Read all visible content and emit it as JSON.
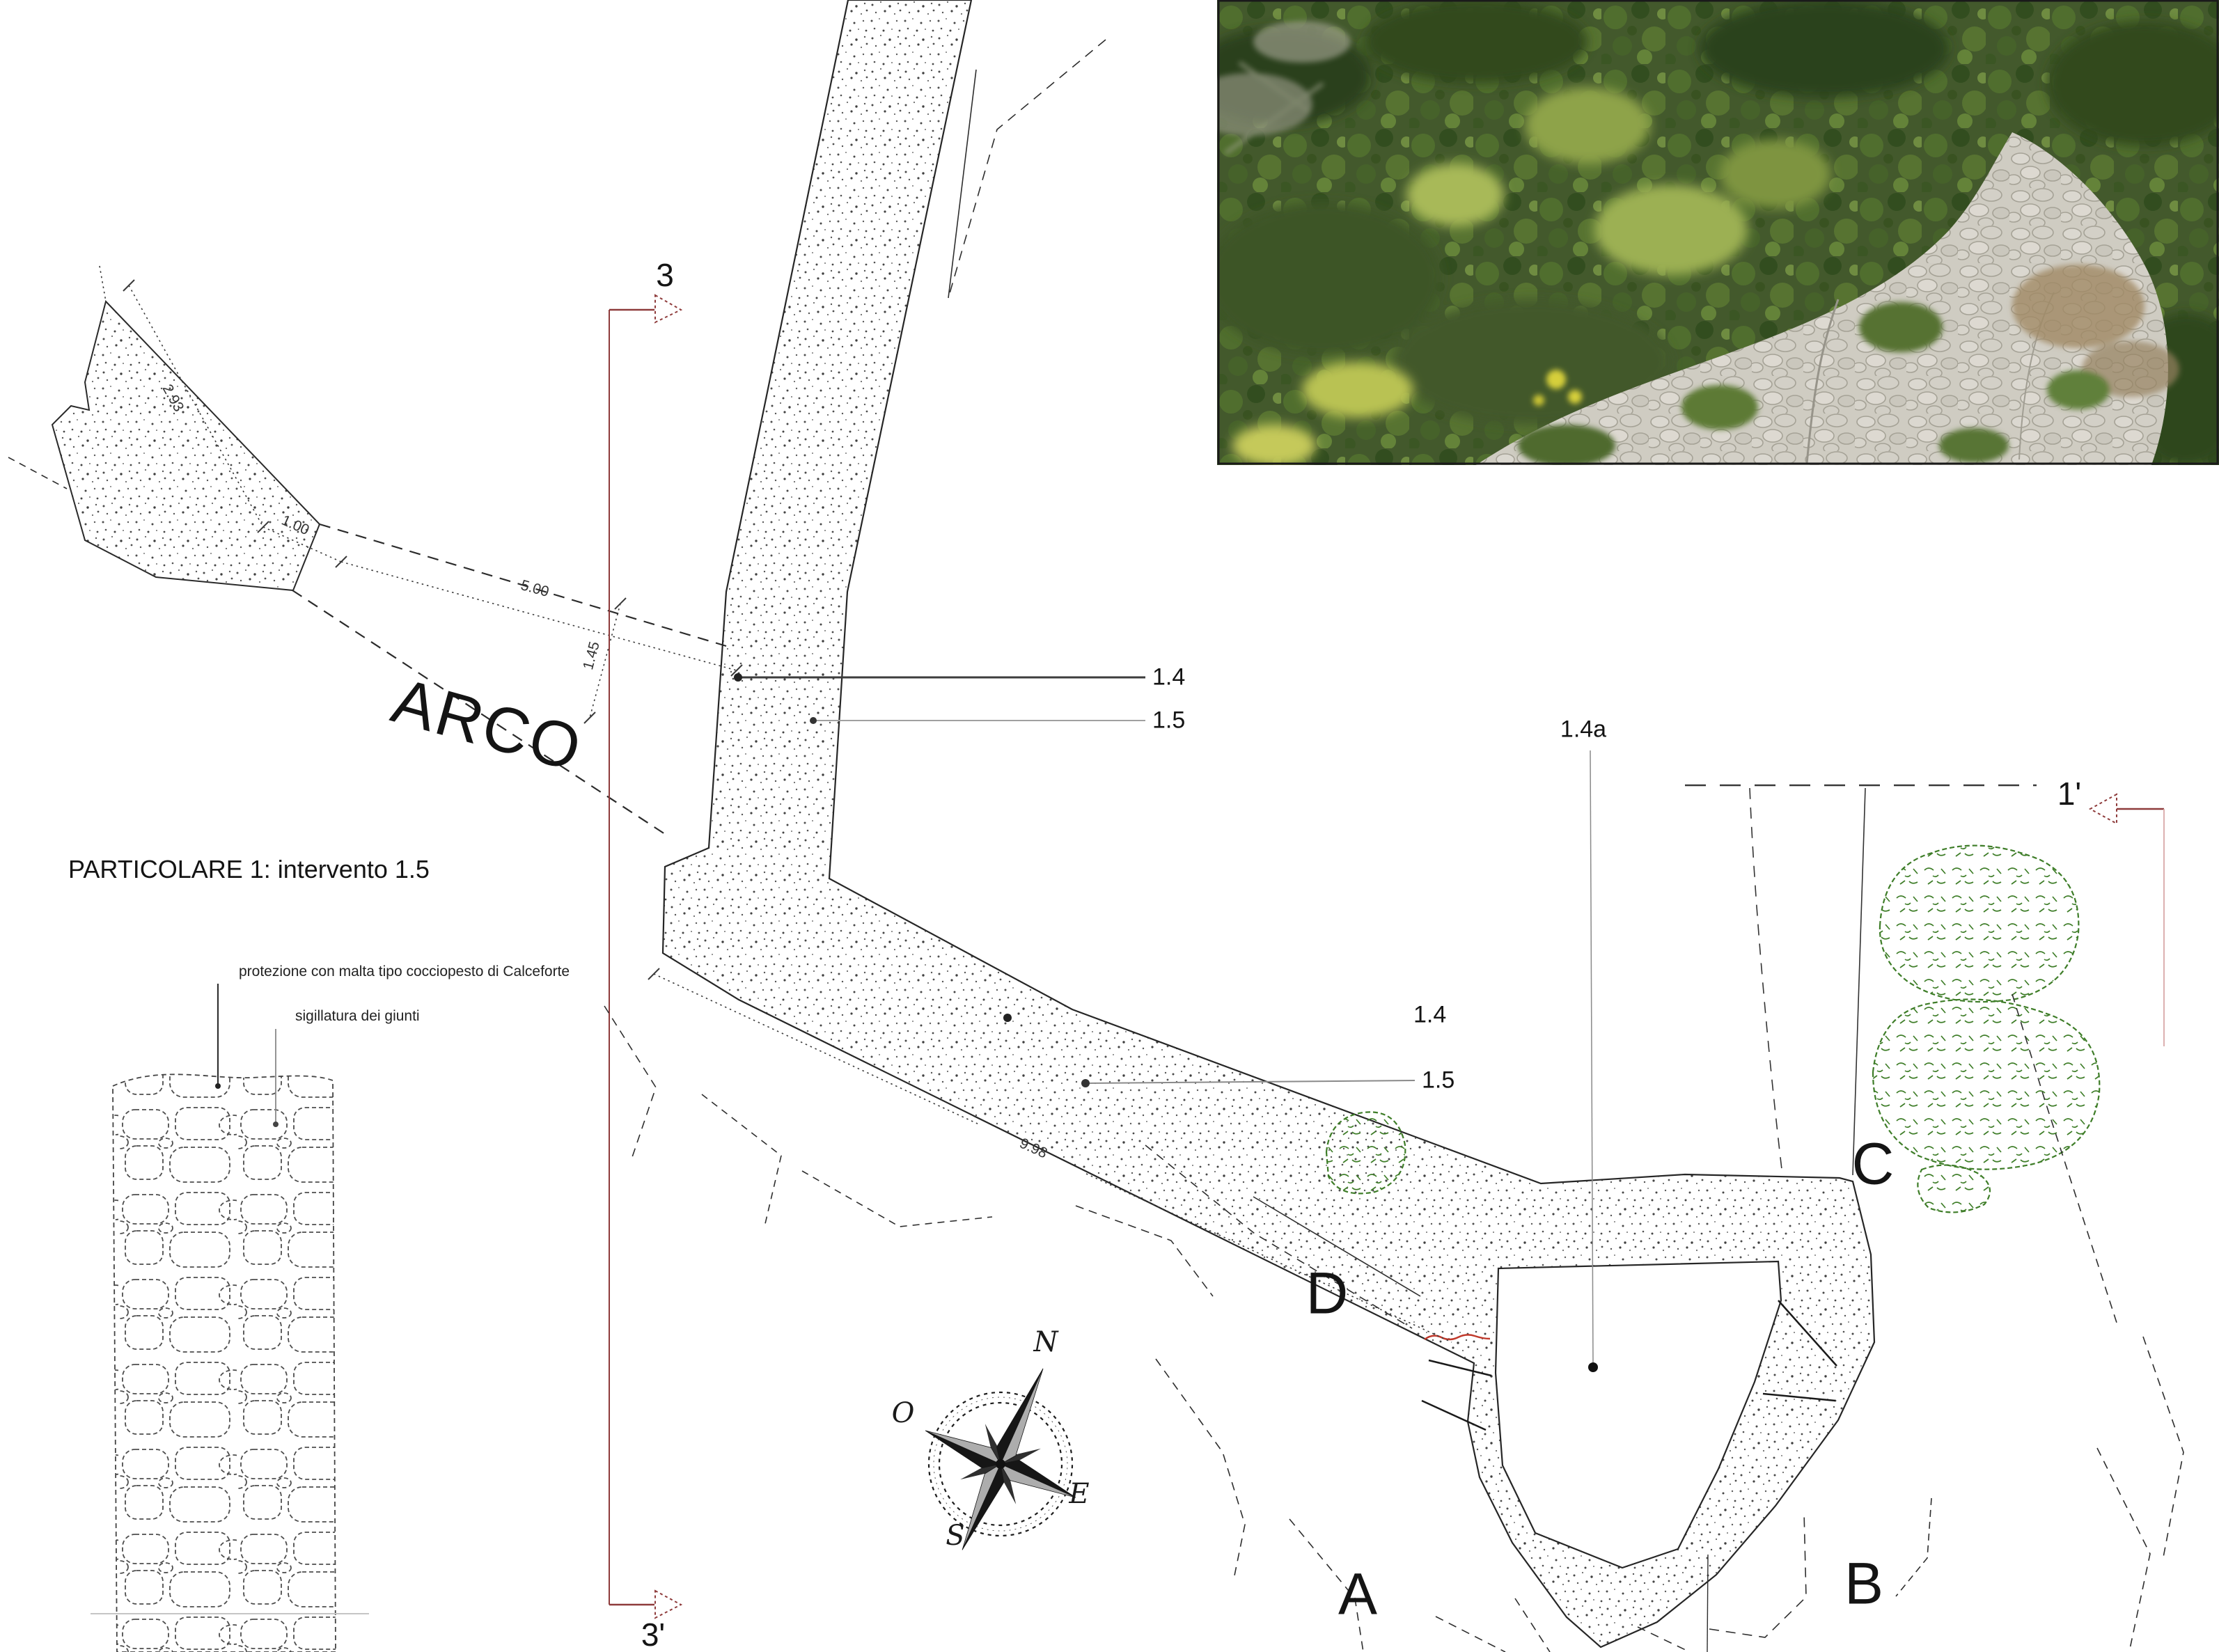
{
  "colors": {
    "section_line": "#8e3b3b",
    "section_line_light": "#d9a7a7",
    "vegetation_outline": "#3e7d28",
    "intervention_mark": "#c0392b",
    "ink": "#1f1f1f"
  },
  "plan": {
    "arco_label": "ARCO",
    "dimensions": {
      "wall_top": "2.93",
      "gap": "1.00",
      "arco_length": "5.00",
      "arco_width": "1.45",
      "wall_length": "9.98"
    },
    "leaders": {
      "top_14": "1.4",
      "top_15": "1.5",
      "mid_14": "1.4",
      "mid_15": "1.5",
      "tower_14a": "1.4a"
    },
    "sections": {
      "s3": "3",
      "s3_prime": "3'",
      "s1_prime": "1'"
    },
    "areas": {
      "a": "A",
      "b": "B",
      "c": "C",
      "d": "D"
    },
    "compass": {
      "n": "N",
      "e": "E",
      "s": "S",
      "o": "O"
    }
  },
  "detail": {
    "title": "PARTICOLARE 1: intervento 1.5",
    "annotations": [
      "protezione con malta tipo cocciopesto di Calceforte",
      "sigillatura dei giunti"
    ]
  }
}
